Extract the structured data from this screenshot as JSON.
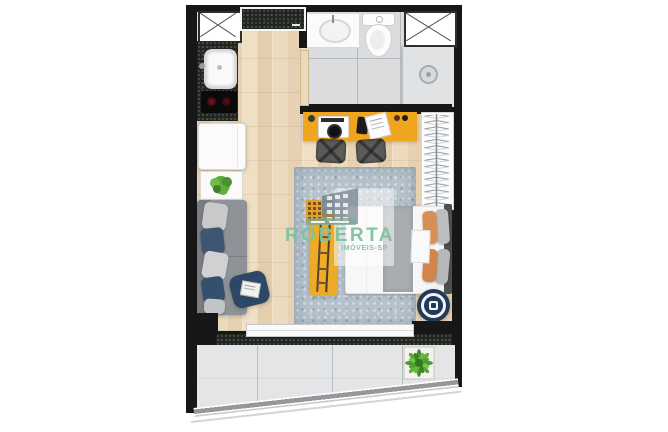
{
  "watermark": {
    "brand": "ROBERTA",
    "agency": "IMÓVEIS-SP",
    "brand_color": "#7ec0a0"
  },
  "plan": {
    "type": "studio-apartment-floor-plan-top-view",
    "rooms": [
      "kitchen",
      "bathroom",
      "living-sleeping-area",
      "balcony"
    ],
    "items": [
      "utility-shaft-left",
      "utility-shaft-right",
      "entry-mat",
      "kitchen-counter",
      "kitchen-sink",
      "cooktop",
      "refrigerator",
      "plant-side-table",
      "sofa",
      "floor-pouf-with-magazine",
      "bathroom-vanity",
      "toilet",
      "shower",
      "bathroom-door",
      "desk",
      "record-player",
      "phone",
      "notebook",
      "desk-chair-left",
      "desk-chair-right",
      "wardrobe-hanger-rail",
      "area-rug",
      "double-bed",
      "yellow-ladder-rack",
      "round-side-table",
      "sliding-glass-door",
      "door-track",
      "balcony-planter-box",
      "glass-railing"
    ],
    "colors": {
      "wall": "#171717",
      "wood_floor": "#e7d4b6",
      "counter_dark": "#20261f",
      "bathroom_floor": "#dbdcde",
      "desk_yellow": "#f0a51e",
      "rug_blue_gray": "#b5c2cc",
      "sofa_gray": "#8f9397",
      "navy_accent": "#2c4866",
      "bed_white": "#f7f7f7",
      "pillow_orange": "#d88f52",
      "balcony_tile": "#e4e5e7",
      "plant_green": "#55a434"
    }
  }
}
